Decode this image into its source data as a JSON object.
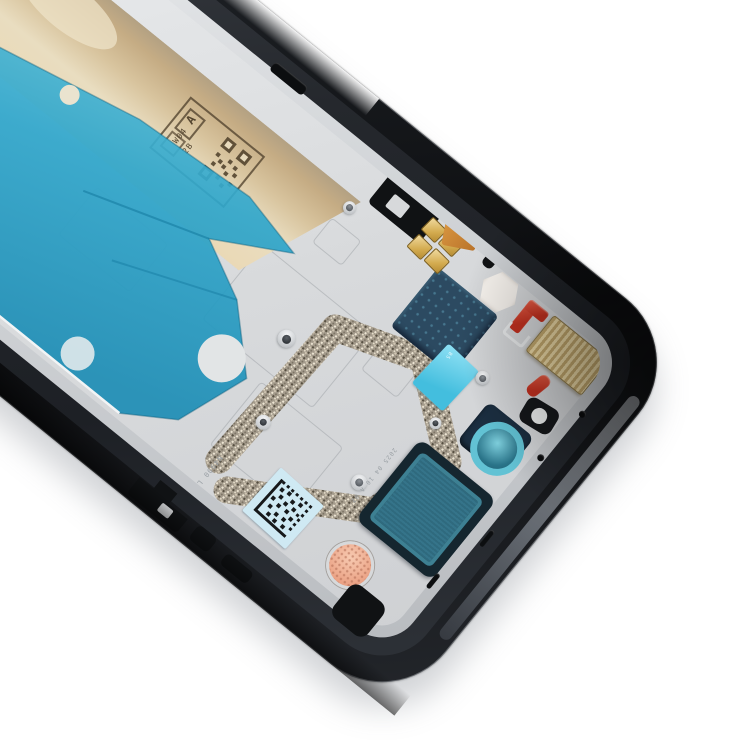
{
  "scene": {
    "background_color": "#ffffff"
  },
  "frame": {
    "rail_black": "#121417",
    "rail_gray_band": "#959ba3",
    "lip_silver": "#d3d6d9",
    "plate_silver": "#dcdee0"
  },
  "adhesives": {
    "tan": "#d8c49e",
    "tan_cream": "#e9ddc0",
    "blue_sheet": "#35aacd",
    "blue_sheet_deep": "#1d8db5",
    "cyan_tab": "#52c8e8"
  },
  "components": {
    "navy_cover_plate": "#2c4a61",
    "gold_pad": "#d3ab4f",
    "gold_flex": "#c8802e",
    "gold_mesh_pad": "#d3ba85",
    "red_seal": "#cf3a28",
    "speaker_frame": "#15262f",
    "speaker_mesh_teal": "#2f6a7e",
    "camera_gasket_ring": "#62c2d4",
    "mic_mesh_peach": "#efb095",
    "glitter_tape": "#a39a8b",
    "datamatrix_sticker_bg": "#cfe9f3",
    "stamp_ink": "#54452f"
  },
  "markings": {
    "stamp_grade": "A",
    "stamp_code_1": "W04",
    "stamp_code_2": "2B",
    "etch_code_side": "N4900 L2021 K",
    "etch_code_date": "2025 04 10 A 02",
    "tab_code": "B5"
  }
}
